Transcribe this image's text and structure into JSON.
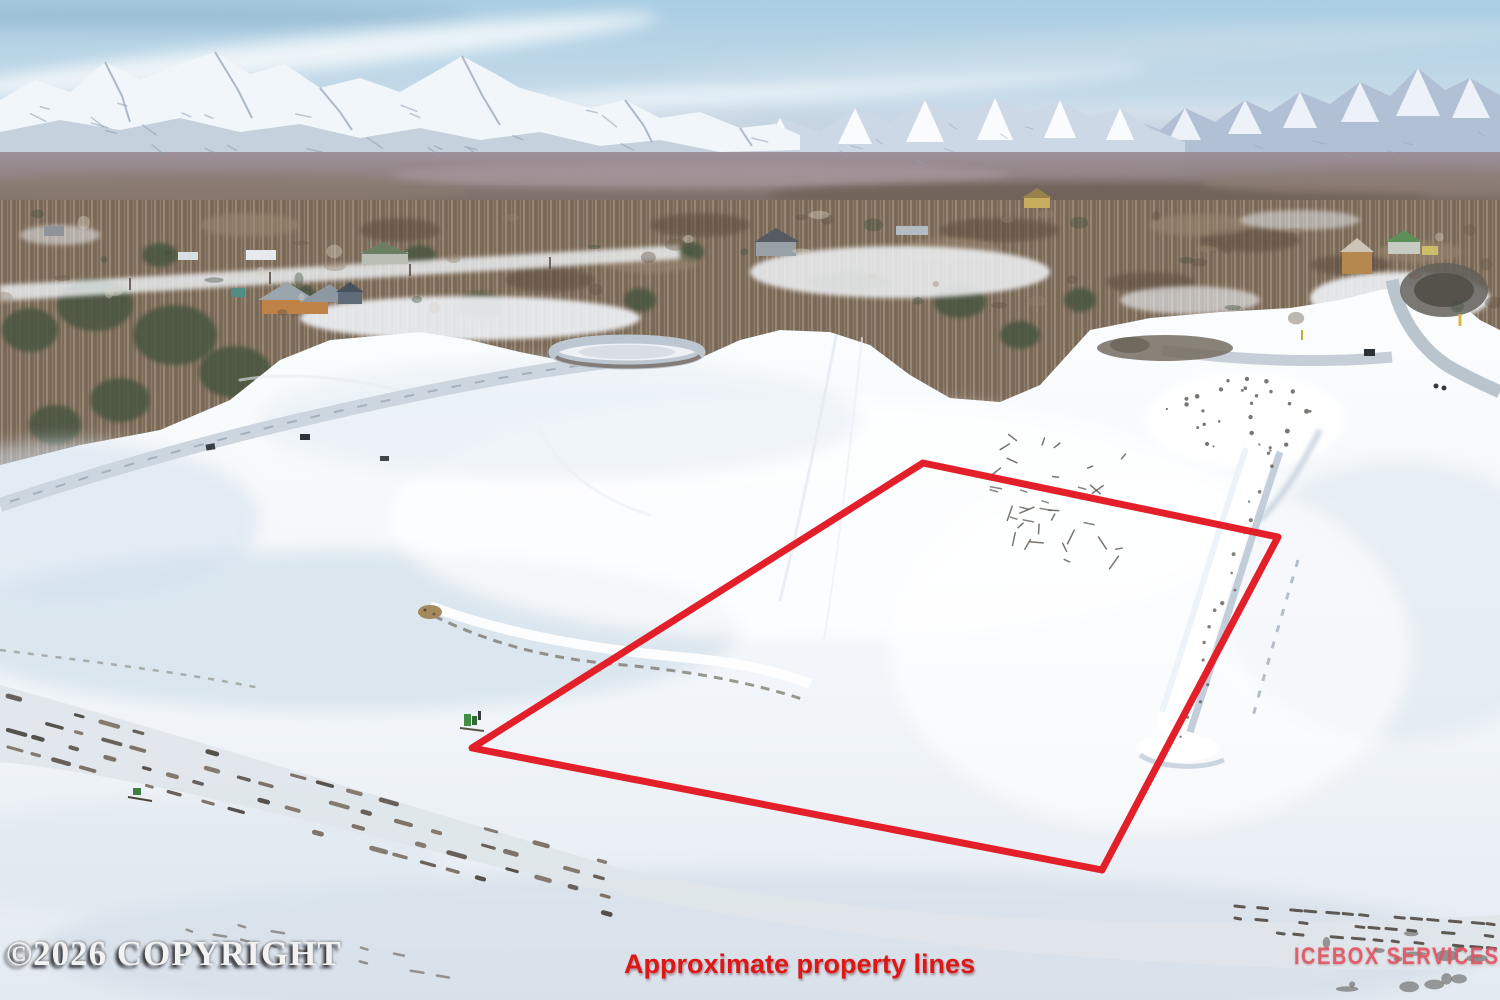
{
  "overlays": {
    "copyright": "©2026 COPYRIGHT",
    "caption": "Approximate property lines",
    "brand": "ICEBOX SERVICES"
  },
  "property_outline": {
    "color": "#e3202a",
    "stroke_width": 7,
    "points": [
      [
        923,
        463
      ],
      [
        1278,
        537
      ],
      [
        1102,
        870
      ],
      [
        472,
        748
      ]
    ]
  },
  "colors": {
    "caption_red": "#dd1616",
    "brand_pink": "rgba(226,87,100,0.92)",
    "copyright_white": "#f2f2f2",
    "sky_blue": "#aecfe3",
    "snow_white": "#f7fafc"
  }
}
